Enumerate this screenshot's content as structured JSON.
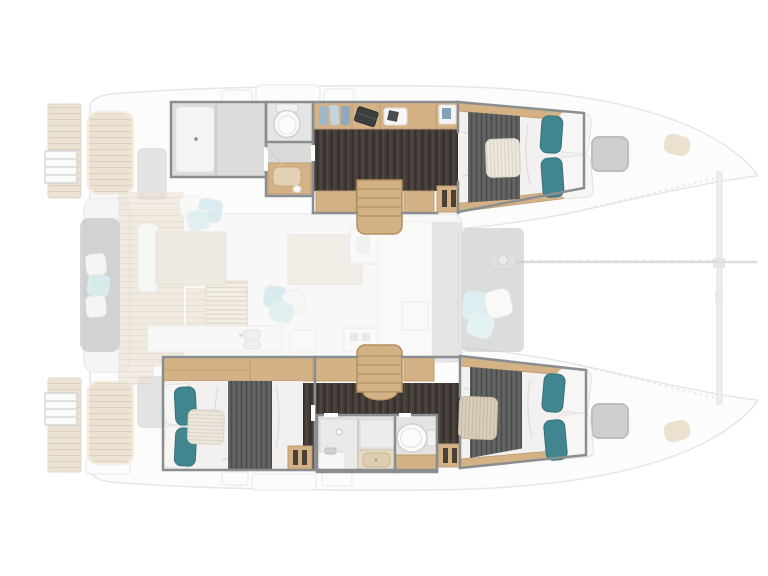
{
  "page": {
    "title": "Catamaran interior layout floor plan",
    "background": "#ffffff"
  },
  "palette": {
    "wood": "#d4b286",
    "wood_stairs": "#d2b184",
    "wood_line": "#bb9c70",
    "deck_wood": "#ece2d4",
    "dark_floor": "#453e39",
    "blanket_gray": "#5d5f5e",
    "mattress_white": "#f2f1ef",
    "pillow_white": "#f7f6f4",
    "teal_pillow": "#41868f",
    "deck_pillow_blue": "#c5e3e7",
    "deck_pillow_blue_2": "#d2eaed",
    "wall_gray": "#8b8e90",
    "bench_gray": "#b9bcbd",
    "table_beige": "#eae2d3",
    "hatch_gray": "#c9cbcc",
    "counter_beige": "#e6d9c4",
    "hull_outline": "#e4e7e8"
  },
  "diagram": {
    "type": "floorplan",
    "vessel": "sailing-catamaran",
    "view": "top-down interior layout, bow to the right, stern to the left",
    "summary": {
      "cabins": 3,
      "double_beds": 3,
      "bathrooms": 2,
      "text_labels": []
    },
    "upper_hull": {
      "rooms": [
        "forward bathroom with shower cubicle",
        "separate WC",
        "vanity washbasin",
        "wardrobe shelf with folded clothes",
        "desk with laptop",
        "companionway stairs",
        "aft double-bed cabin with gray throw and teal pillows"
      ]
    },
    "lower_hull": {
      "rooms": [
        "forward double-bed cabin with teal pillows",
        "companionway stairs",
        "central bathroom with shower, washbasin and WC",
        "aft double-bed cabin with gray throw and teal pillows"
      ]
    },
    "main_deck": [
      "stern swim platforms with boarding ladders",
      "aft cockpit bench with cushions",
      "teak cockpit decking",
      "louvered deck grate",
      "saloon table with sofa",
      "chaise longue with cushions",
      "galley counters with twin sink",
      "forward cockpit lounge cushions",
      "anchor windlass with chain line to forward crossbeam",
      "two gray deck hatches",
      "trampoline area between bows"
    ]
  },
  "class_fills": {
    "wood": "#d4b286",
    "woodstairs": "#d2b184",
    "mattress": "#f2f1ef",
    "pillowwhite": "#f7f6f4",
    "teal": "#41868f",
    "lightteal": "#c5e3e7",
    "lightteal2": "#d2eaed",
    "bench": "#b9bcbd",
    "table": "#eae2d3",
    "hatch": "#c9cbcc",
    "counterbeige": "#e6d9c4"
  },
  "class_strokes": {
    "wall": "#8b8e90",
    "woodline": "#bb9c70",
    "hullline": "#e4e7e8"
  }
}
